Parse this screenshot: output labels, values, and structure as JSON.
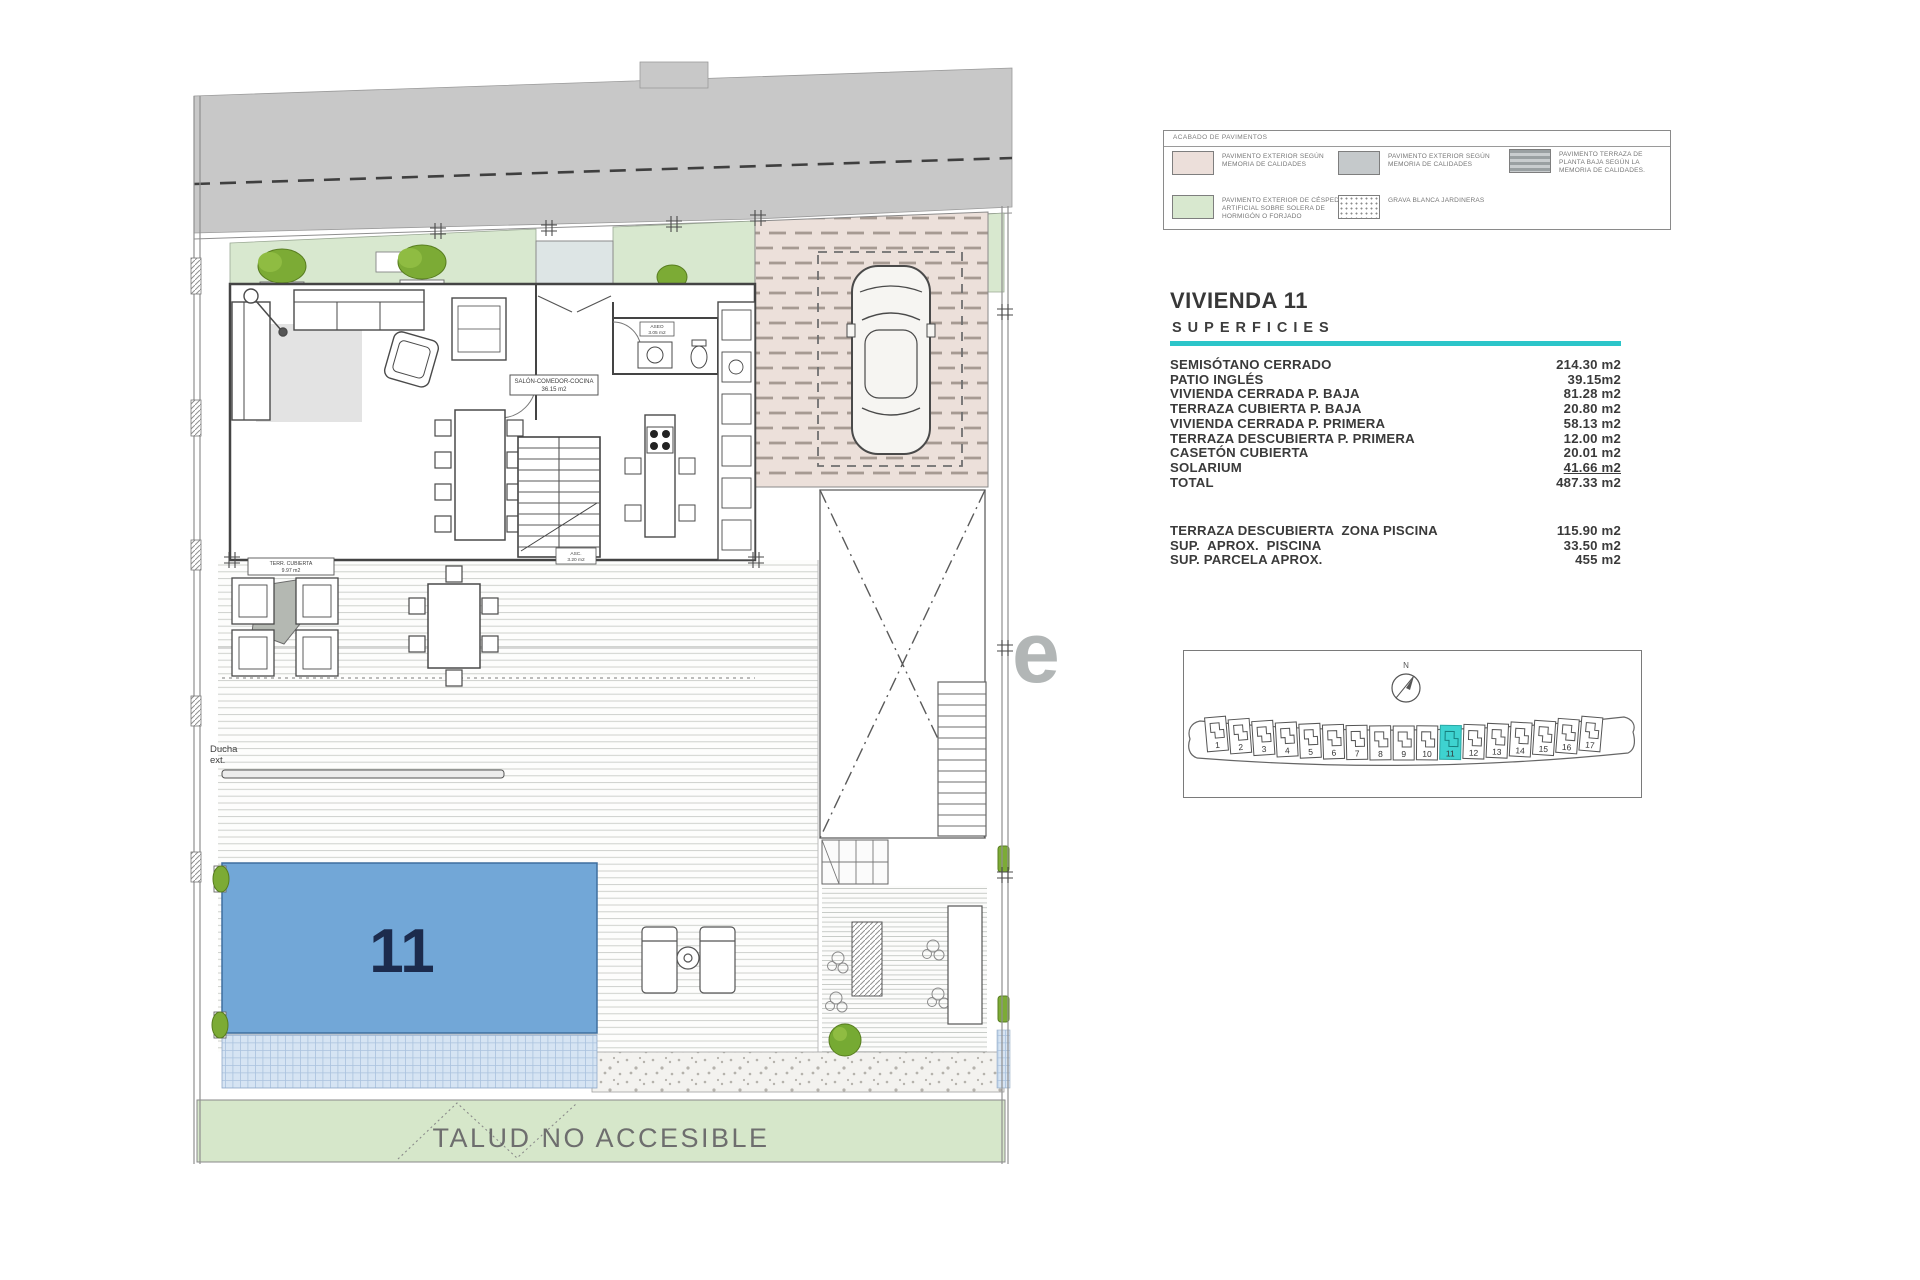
{
  "legend": {
    "title": "ACABADO DE PAVIMENTOS",
    "items": [
      {
        "label": "PAVIMENTO EXTERIOR SEGÚN MEMORIA DE CALIDADES"
      },
      {
        "label": "PAVIMENTO EXTERIOR SEGÚN MEMORIA DE CALIDADES"
      },
      {
        "label": "PAVIMENTO TERRAZA DE PLANTA BAJA SEGÚN LA MEMORIA DE CALIDADES."
      },
      {
        "label": "PAVIMENTO EXTERIOR DE CÉSPED ARTIFICIAL SOBRE SOLERA DE HORMIGÓN O FORJADO"
      },
      {
        "label": "GRAVA BLANCA JARDINERAS"
      }
    ],
    "colors": {
      "pink": "#ecdfda",
      "gray": "#c5c9cb",
      "striped": "#b9bdbf",
      "green": "#d8e8cf"
    }
  },
  "summary": {
    "title": "VIVIENDA 11",
    "subtitle": "SUPERFICIES",
    "accent_color": "#2cc5c9",
    "rows": [
      {
        "label": "SEMISÓTANO CERRADO",
        "value": "214.30 m2"
      },
      {
        "label": "PATIO INGLÉS",
        "value": "39.15m2"
      },
      {
        "label": "VIVIENDA CERRADA P. BAJA",
        "value": "81.28 m2"
      },
      {
        "label": "TERRAZA CUBIERTA P. BAJA",
        "value": "20.80 m2"
      },
      {
        "label": "VIVIENDA CERRADA P. PRIMERA",
        "value": "58.13 m2"
      },
      {
        "label": "TERRAZA DESCUBIERTA P. PRIMERA",
        "value": "12.00 m2"
      },
      {
        "label": "CASETÓN CUBIERTA",
        "value": "20.01 m2"
      },
      {
        "label": "SOLARIUM",
        "value": "41.66 m2",
        "underline": true
      },
      {
        "label": "TOTAL",
        "value": "487.33 m2"
      }
    ],
    "extra_rows": [
      {
        "label": "TERRAZA DESCUBIERTA  ZONA PISCINA",
        "value": "115.90 m2"
      },
      {
        "label": "SUP.  APROX.  PISCINA",
        "value": "33.50 m2"
      },
      {
        "label": "SUP. PARCELA APROX.",
        "value": "455 m2"
      }
    ]
  },
  "keyplan": {
    "north_label": "N",
    "plots": [
      "1",
      "2",
      "3",
      "4",
      "5",
      "6",
      "7",
      "8",
      "9",
      "10",
      "11",
      "12",
      "13",
      "14",
      "15",
      "16",
      "17"
    ],
    "highlighted_plot": "11",
    "highlight_color": "#3ed3d0"
  },
  "plan": {
    "pool_number": "11",
    "talud_label": "TALUD NO ACCESIBLE",
    "shower_label_line1": "Ducha",
    "shower_label_line2": "ext.",
    "salon_label": "SALÓN-COMEDOR-COCINA",
    "salon_area": "36.15 m2",
    "terrace_label": "TERR. CUBIERTA",
    "terrace_area": "9.97 m2",
    "bath_label": "ASEO",
    "bath_area": "3.05 m2",
    "stair_label": "ASC.",
    "stair_area": "3.20 m2",
    "watermark": "e",
    "pool_color": "#72a7d7",
    "grass_color": "#d8e8cf",
    "street_color": "#c8c8c8",
    "garage_color": "#ece0da",
    "talud_color": "#d6e7ca"
  }
}
